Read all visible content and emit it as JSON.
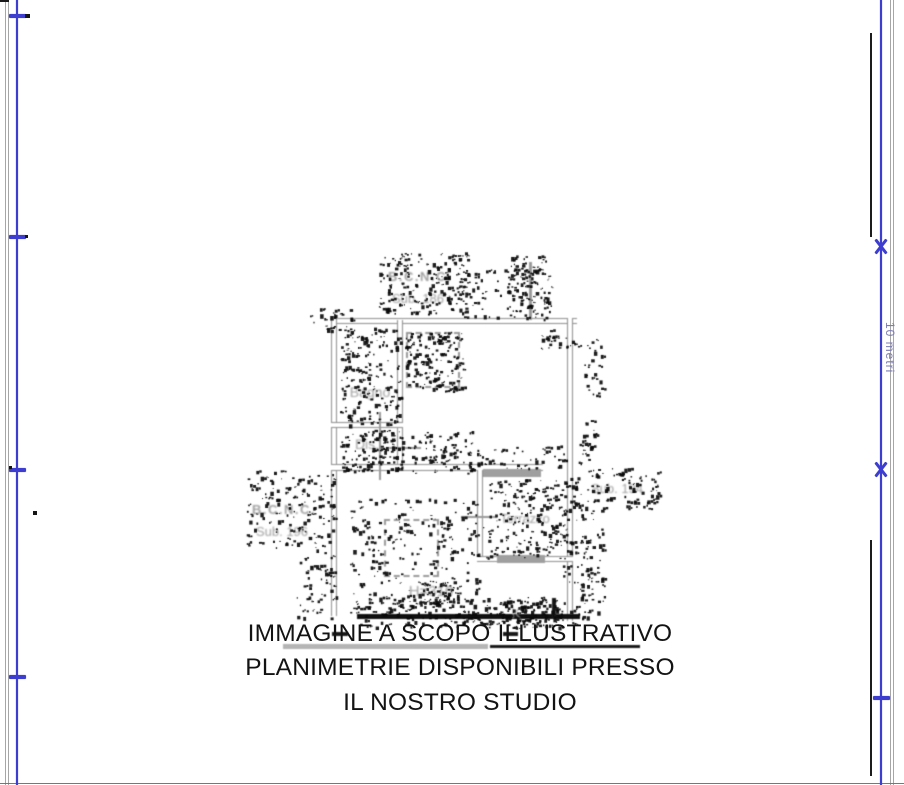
{
  "page": {
    "overlay": {
      "lines": [
        "IMMAGINE A SCOPO ILLUSTRATIVO",
        "PLANIMETRIE DISPONIBILI PRESSO",
        "IL NOSTRO STUDIO"
      ]
    },
    "dimension_label": "10 metri",
    "plan_labels": {
      "bcnc_top_line1": "B.C.N.C.",
      "bcnc_top_line2": "Sub. 186",
      "bathroom": "Bagno",
      "hallway": "Dis.",
      "terrace": "Terrazzo",
      "sub_right": "Sub. 194",
      "bcnc_left_line1": "B.C.N.C.",
      "bcnc_left_line2": "Sub. 196",
      "ceiling_height": "H=310",
      "door_mark": "K"
    },
    "colors": {
      "dimension_blue": "#3d3dd0",
      "wall_gray": "#8d8d8d",
      "label_gray": "#a0a0a0"
    }
  }
}
